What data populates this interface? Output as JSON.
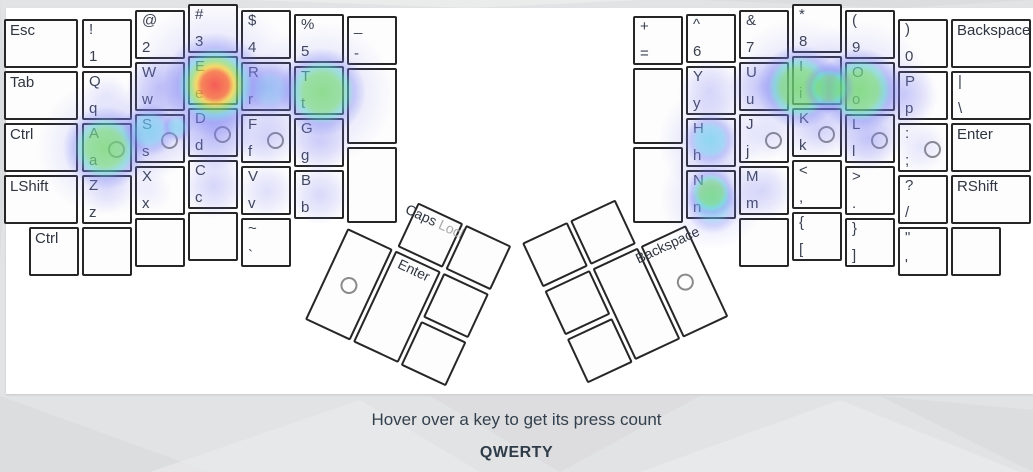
{
  "page": {
    "footer_hint": "Hover over a key to get its press count",
    "layout_label": "QWERTY"
  },
  "palette": {
    "heat_red": "#fa463c",
    "heat_yellow": "#fcd72d",
    "heat_green": "#64dc64",
    "heat_cyan": "#64d4eb",
    "heat_blue": "#7a7af3",
    "key_border": "#262626",
    "key_bg": "#fdfdfd",
    "text": "#3a4150",
    "page_bg": "#e2e3e4"
  },
  "keys": [
    {
      "id": "esc",
      "label": "Esc",
      "x": 4,
      "y": 19,
      "w": 74
    },
    {
      "id": "tab",
      "label": "Tab",
      "x": 4,
      "y": 71,
      "w": 74
    },
    {
      "id": "lctrl",
      "label": "Ctrl",
      "x": 4,
      "y": 123,
      "w": 74
    },
    {
      "id": "lshift",
      "label": "LShift",
      "x": 4,
      "y": 175,
      "w": 74
    },
    {
      "id": "lctrl2",
      "label": "Ctrl",
      "x": 29,
      "y": 227
    },
    {
      "id": "1",
      "shift": "!",
      "base": "1",
      "x": 82,
      "y": 19
    },
    {
      "id": "q",
      "shift": "Q",
      "base": "q",
      "x": 82,
      "y": 71
    },
    {
      "id": "a",
      "shift": "A",
      "base": "a",
      "x": 82,
      "y": 123,
      "ring": 1
    },
    {
      "id": "z",
      "shift": "Z",
      "base": "z",
      "x": 82,
      "y": 175
    },
    {
      "id": "lblank1",
      "x": 82,
      "y": 227
    },
    {
      "id": "2",
      "shift": "@",
      "base": "2",
      "x": 135,
      "y": 10
    },
    {
      "id": "w",
      "shift": "W",
      "base": "w",
      "x": 135,
      "y": 62
    },
    {
      "id": "s",
      "shift": "S",
      "base": "s",
      "x": 135,
      "y": 114,
      "ring": 1
    },
    {
      "id": "x",
      "shift": "X",
      "base": "x",
      "x": 135,
      "y": 166
    },
    {
      "id": "lblank2",
      "x": 135,
      "y": 218
    },
    {
      "id": "3",
      "shift": "#",
      "base": "3",
      "x": 188,
      "y": 4
    },
    {
      "id": "e",
      "shift": "E",
      "base": "e",
      "x": 188,
      "y": 56
    },
    {
      "id": "d",
      "shift": "D",
      "base": "d",
      "x": 188,
      "y": 108,
      "ring": 1
    },
    {
      "id": "c",
      "shift": "C",
      "base": "c",
      "x": 188,
      "y": 160
    },
    {
      "id": "lblank3",
      "x": 188,
      "y": 212
    },
    {
      "id": "4",
      "shift": "$",
      "base": "4",
      "x": 241,
      "y": 10
    },
    {
      "id": "r",
      "shift": "R",
      "base": "r",
      "x": 241,
      "y": 62
    },
    {
      "id": "f",
      "shift": "F",
      "base": "f",
      "x": 241,
      "y": 114,
      "ring": 1
    },
    {
      "id": "v",
      "shift": "V",
      "base": "v",
      "x": 241,
      "y": 166
    },
    {
      "id": "grave",
      "shift": "~",
      "base": "`",
      "x": 241,
      "y": 218
    },
    {
      "id": "5",
      "shift": "%",
      "base": "5",
      "x": 294,
      "y": 14
    },
    {
      "id": "t",
      "shift": "T",
      "base": "t",
      "x": 294,
      "y": 66
    },
    {
      "id": "g",
      "shift": "G",
      "base": "g",
      "x": 294,
      "y": 118
    },
    {
      "id": "b",
      "shift": "B",
      "base": "b",
      "x": 294,
      "y": 170
    },
    {
      "id": "minus",
      "shift": "_",
      "base": "-",
      "x": 347,
      "y": 16
    },
    {
      "id": "ltall1",
      "x": 347,
      "y": 68,
      "h": 76
    },
    {
      "id": "ltall2",
      "x": 347,
      "y": 147,
      "h": 76
    },
    {
      "id": "equals",
      "shift": "+",
      "base": "=",
      "x": 633,
      "y": 16
    },
    {
      "id": "rtall1",
      "x": 633,
      "y": 68,
      "h": 76
    },
    {
      "id": "rtall2",
      "x": 633,
      "y": 147,
      "h": 76
    },
    {
      "id": "6",
      "shift": "^",
      "base": "6",
      "x": 686,
      "y": 14
    },
    {
      "id": "y",
      "shift": "Y",
      "base": "y",
      "x": 686,
      "y": 66
    },
    {
      "id": "h",
      "shift": "H",
      "base": "h",
      "x": 686,
      "y": 118
    },
    {
      "id": "n",
      "shift": "N",
      "base": "n",
      "x": 686,
      "y": 170
    },
    {
      "id": "7",
      "shift": "&",
      "base": "7",
      "x": 739,
      "y": 10
    },
    {
      "id": "u",
      "shift": "U",
      "base": "u",
      "x": 739,
      "y": 62
    },
    {
      "id": "j",
      "shift": "J",
      "base": "j",
      "x": 739,
      "y": 114,
      "ring": 1
    },
    {
      "id": "m",
      "shift": "M",
      "base": "m",
      "x": 739,
      "y": 166
    },
    {
      "id": "rblank1",
      "x": 739,
      "y": 218
    },
    {
      "id": "8",
      "shift": "*",
      "base": "8",
      "x": 792,
      "y": 4
    },
    {
      "id": "i",
      "shift": "I",
      "base": "i",
      "x": 792,
      "y": 56
    },
    {
      "id": "k",
      "shift": "K",
      "base": "k",
      "x": 792,
      "y": 108,
      "ring": 1
    },
    {
      "id": "comma",
      "shift": "<",
      "base": ",",
      "x": 792,
      "y": 160
    },
    {
      "id": "lbracket",
      "shift": "{",
      "base": "[",
      "x": 792,
      "y": 212
    },
    {
      "id": "9",
      "shift": "(",
      "base": "9",
      "x": 845,
      "y": 10
    },
    {
      "id": "o",
      "shift": "O",
      "base": "o",
      "x": 845,
      "y": 62
    },
    {
      "id": "l",
      "shift": "L",
      "base": "l",
      "x": 845,
      "y": 114,
      "ring": 1
    },
    {
      "id": "period",
      "shift": ">",
      "base": ".",
      "x": 845,
      "y": 166
    },
    {
      "id": "rbracket",
      "shift": "}",
      "base": "]",
      "x": 845,
      "y": 218
    },
    {
      "id": "0",
      "shift": ")",
      "base": "0",
      "x": 898,
      "y": 19
    },
    {
      "id": "p",
      "shift": "P",
      "base": "p",
      "x": 898,
      "y": 71
    },
    {
      "id": "semicolon",
      "shift": ":",
      "base": ";",
      "x": 898,
      "y": 123,
      "ring": 1
    },
    {
      "id": "slash",
      "shift": "?",
      "base": "/",
      "x": 898,
      "y": 175
    },
    {
      "id": "quote",
      "shift": "\"",
      "base": "'",
      "x": 898,
      "y": 227
    },
    {
      "id": "backspace",
      "label": "Backspace",
      "x": 951,
      "y": 19,
      "w": 80
    },
    {
      "id": "backslash",
      "shift": "|",
      "base": "\\",
      "x": 951,
      "y": 71,
      "w": 80
    },
    {
      "id": "enter",
      "label": "Enter",
      "x": 951,
      "y": 123,
      "w": 80
    },
    {
      "id": "rshift",
      "label": "RShift",
      "x": 951,
      "y": 175,
      "w": 80
    },
    {
      "id": "rblank2",
      "x": 951,
      "y": 227
    },
    {
      "id": "capslock",
      "label": "Caps ",
      "label_muted": "Lock",
      "x": 53,
      "y": 0,
      "thumb": "left"
    },
    {
      "id": "tl-top",
      "x": 106,
      "y": 0,
      "thumb": "left"
    },
    {
      "id": "tl-big",
      "x": 0,
      "y": 53,
      "h": 101,
      "thumb": "left",
      "ring": 1
    },
    {
      "id": "thumb-enter",
      "label": "Enter",
      "x": 53,
      "y": 53,
      "h": 101,
      "thumb": "left"
    },
    {
      "id": "tl-small1",
      "x": 106,
      "y": 53,
      "thumb": "left"
    },
    {
      "id": "tl-small2",
      "x": 106,
      "y": 106,
      "thumb": "left"
    },
    {
      "id": "tr-top1",
      "x": 0,
      "y": 0,
      "thumb": "right"
    },
    {
      "id": "tr-top2",
      "x": 53,
      "y": 0,
      "thumb": "right"
    },
    {
      "id": "tr-small1",
      "x": 0,
      "y": 53,
      "thumb": "right"
    },
    {
      "id": "tr-small2",
      "x": 0,
      "y": 106,
      "thumb": "right"
    },
    {
      "id": "tr-big",
      "x": 53,
      "y": 53,
      "h": 101,
      "thumb": "right"
    },
    {
      "id": "thumb-backspace",
      "label": "Backspace",
      "x": 106,
      "y": 53,
      "h": 101,
      "thumb": "right",
      "ring": 1
    }
  ],
  "heat": [
    [
      215,
      88,
      88,
      "blue",
      0.55
    ],
    [
      160,
      87,
      34,
      "blue",
      0.8
    ],
    [
      267,
      87,
      34,
      "blue",
      0.85
    ],
    [
      270,
      90,
      26,
      "cyan",
      0.5
    ],
    [
      322,
      94,
      72,
      "blue",
      0.5
    ],
    [
      105,
      148,
      68,
      "blue",
      0.5
    ],
    [
      150,
      132,
      48,
      "blue",
      0.5
    ],
    [
      214,
      133,
      38,
      "blue",
      0.85
    ],
    [
      267,
      139,
      30,
      "blue",
      0.55
    ],
    [
      320,
      142,
      32,
      "blue",
      0.6
    ],
    [
      214,
      186,
      32,
      "blue",
      0.6
    ],
    [
      267,
      191,
      28,
      "blue",
      0.45
    ],
    [
      320,
      195,
      30,
      "blue",
      0.55
    ],
    [
      107,
      95,
      22,
      "blue",
      0.25
    ],
    [
      107,
      190,
      24,
      "blue",
      0.3
    ],
    [
      152,
      192,
      20,
      "blue",
      0.2
    ],
    [
      215,
      85,
      52,
      "red",
      1
    ],
    [
      322,
      92,
      44,
      "green",
      0.95
    ],
    [
      105,
      148,
      42,
      "green",
      0.95
    ],
    [
      149,
      130,
      27,
      "cyan",
      0.9
    ],
    [
      177,
      127,
      15,
      "cyan",
      0.8
    ],
    [
      799,
      90,
      72,
      "blue",
      0.5
    ],
    [
      860,
      92,
      72,
      "blue",
      0.5
    ],
    [
      710,
      141,
      52,
      "blue",
      0.5
    ],
    [
      712,
      198,
      52,
      "blue",
      0.5
    ],
    [
      710,
      90,
      32,
      "blue",
      0.6
    ],
    [
      763,
      87,
      34,
      "blue",
      0.7
    ],
    [
      904,
      95,
      34,
      "blue",
      0.65
    ],
    [
      868,
      139,
      32,
      "blue",
      0.75
    ],
    [
      817,
      132,
      26,
      "blue",
      0.35
    ],
    [
      763,
      138,
      24,
      "blue",
      0.3
    ],
    [
      763,
      191,
      30,
      "blue",
      0.6
    ],
    [
      921,
      147,
      26,
      "blue",
      0.35
    ],
    [
      799,
      87,
      42,
      "green",
      1
    ],
    [
      860,
      90,
      42,
      "green",
      1
    ],
    [
      829,
      88,
      26,
      "green",
      0.85
    ],
    [
      710,
      140,
      27,
      "cyan",
      0.95
    ],
    [
      713,
      206,
      28,
      "cyan",
      0.75
    ],
    [
      711,
      193,
      26,
      "green",
      0.9
    ]
  ]
}
